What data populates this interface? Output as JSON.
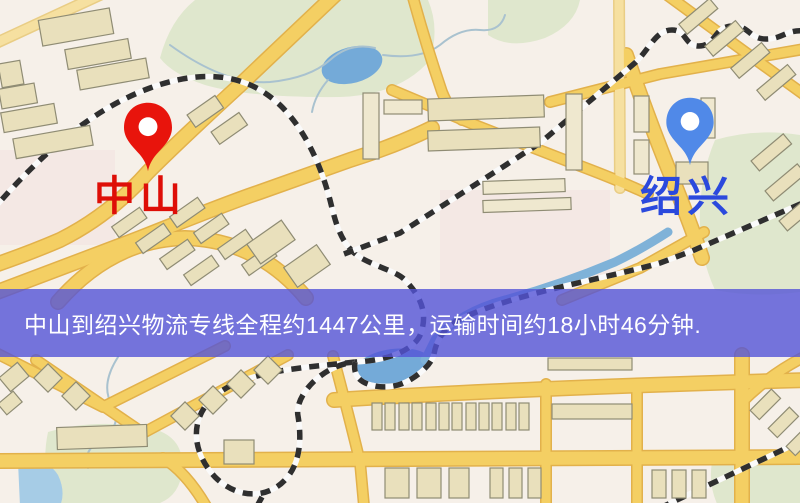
{
  "markers": [
    {
      "name": "origin",
      "label": "中山"
    },
    {
      "name": "destination",
      "label": "绍兴"
    }
  ],
  "banner": {
    "text": "中山到绍兴物流专线全程约1447公里，运输时间约18小时46分钟."
  },
  "palette": {
    "bg": "#f6f0e9",
    "park": "#dfe7cd",
    "water": "#74aad8",
    "water_light": "#a6cce6",
    "river": "#7fb2d8",
    "stream": "#a9c2cf",
    "road_fill": "#f4cf63",
    "road_edge": "#e2b14b",
    "road_pale": "#f6e0a0",
    "pale_edge": "#e9cd85",
    "bld": "#e9e0bc",
    "bld_edge": "#8f8c74",
    "rail_dark": "#2f2f2f",
    "rail_light": "#fafafa",
    "pin_origin": "#e8140c",
    "label_origin": "#de0e07",
    "pin_dest": "#5089e8",
    "label_dest": "#2b49dd",
    "banner_bg": "rgba(84,84,215,0.8)",
    "banner_text": "#ffffff"
  }
}
